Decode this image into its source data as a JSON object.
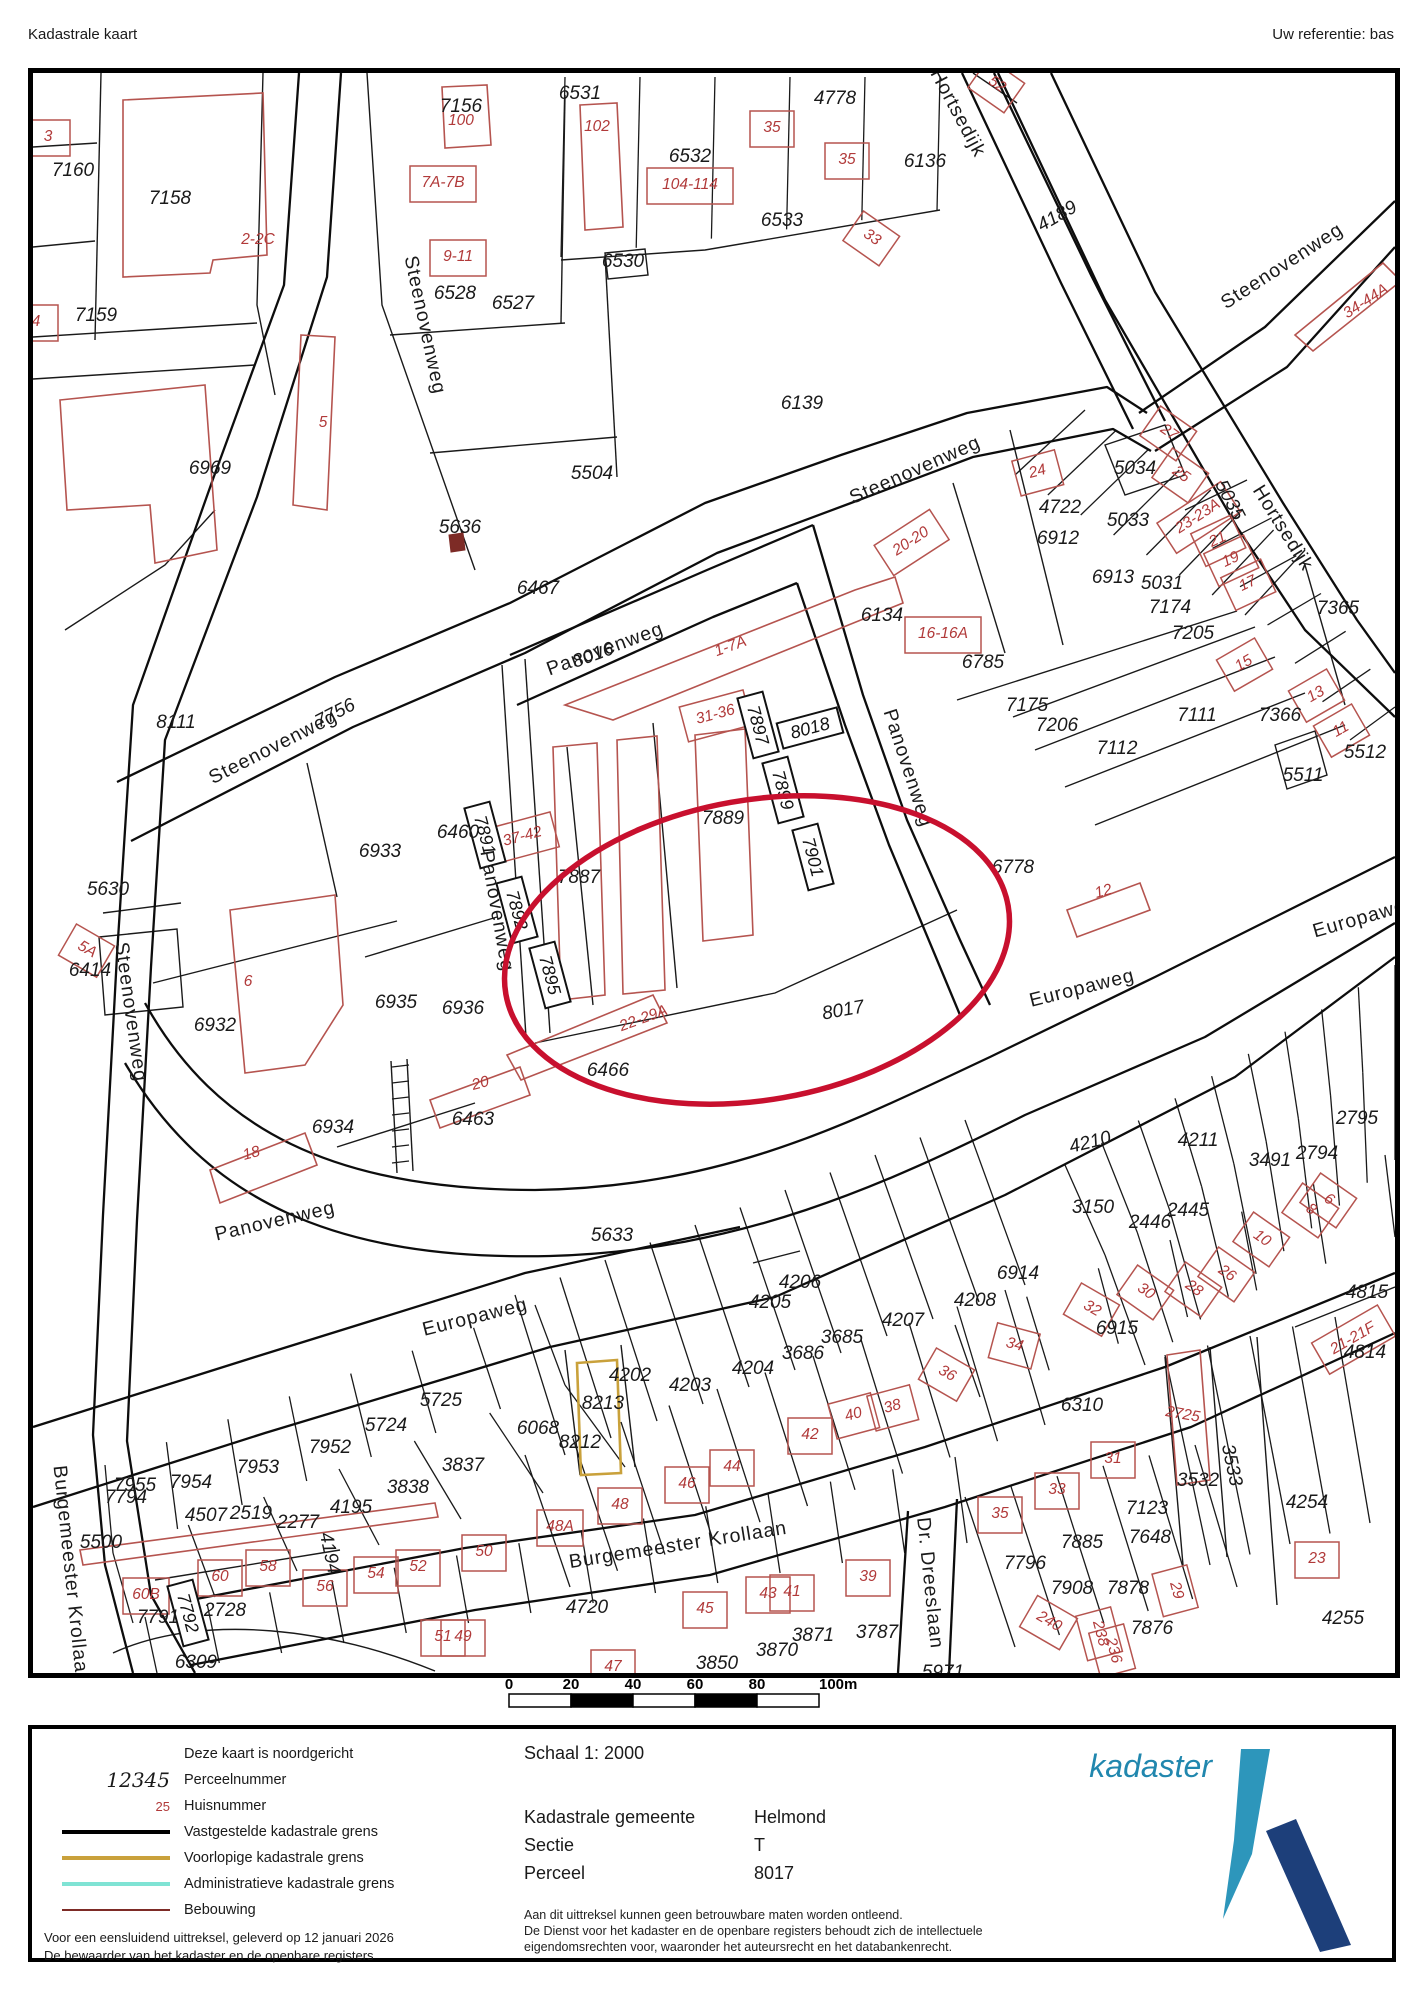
{
  "header": {
    "title": "Kadastrale kaart",
    "reference": "Uw referentie: bas"
  },
  "map": {
    "highlight_color": "#c8102e",
    "parcel_text_color": "#1a1a1a",
    "house_text_color": "#b13a3a",
    "building_color": "#b5544f",
    "boundary_color": "#1a1a1a",
    "provisional_color": "#c9a13b",
    "labels": [
      [
        "Steenovenweg",
        420,
        320,
        78,
        "r"
      ],
      [
        "Steenovenweg",
        268,
        742,
        -27,
        "r"
      ],
      [
        "Steenovenweg",
        910,
        465,
        -24,
        "r"
      ],
      [
        "Steenovenweg",
        1277,
        261,
        -33,
        "r"
      ],
      [
        "Steenovenweg",
        126,
        1007,
        82,
        "r"
      ],
      [
        "Hortsedijk",
        953,
        108,
        62,
        "r"
      ],
      [
        "Hortsedijk",
        1278,
        523,
        58,
        "r"
      ],
      [
        "Panovenweg",
        600,
        644,
        -20,
        "r"
      ],
      [
        "Panovenweg",
        903,
        763,
        72,
        "r"
      ],
      [
        "Panovenweg",
        492,
        906,
        80,
        "r"
      ],
      [
        "Panovenweg",
        270,
        1216,
        -13,
        "r"
      ],
      [
        "Europaweg",
        1077,
        983,
        -14,
        "r"
      ],
      [
        "Europaweg",
        1360,
        912,
        -16,
        "r"
      ],
      [
        "Europaweg",
        470,
        1312,
        -14,
        "r"
      ],
      [
        "Burgemeester Krollaan",
        673,
        1540,
        -9,
        "r"
      ],
      [
        "Burgemeester Krollaan",
        66,
        1570,
        84,
        "r"
      ],
      [
        "Dr. Dreeslaan",
        925,
        1578,
        84,
        "r"
      ],
      [
        "7160",
        68,
        165,
        0,
        "p"
      ],
      [
        "7158",
        165,
        193,
        0,
        "p"
      ],
      [
        "7159",
        91,
        310,
        0,
        "p"
      ],
      [
        "7156",
        456,
        101,
        0,
        "p"
      ],
      [
        "6528",
        450,
        288,
        0,
        "p"
      ],
      [
        "6527",
        508,
        298,
        0,
        "p"
      ],
      [
        "6531",
        575,
        88,
        0,
        "p"
      ],
      [
        "6530",
        618,
        256,
        0,
        "p"
      ],
      [
        "6532",
        685,
        151,
        0,
        "p"
      ],
      [
        "6533",
        777,
        215,
        0,
        "p"
      ],
      [
        "4778",
        830,
        93,
        0,
        "p"
      ],
      [
        "6136",
        920,
        156,
        0,
        "p"
      ],
      [
        "5504",
        587,
        468,
        0,
        "p"
      ],
      [
        "6139",
        797,
        398,
        0,
        "p"
      ],
      [
        "6969",
        205,
        463,
        0,
        "p"
      ],
      [
        "4189",
        1052,
        211,
        -30,
        "p"
      ],
      [
        "5034",
        1130,
        463,
        0,
        "p"
      ],
      [
        "5033",
        1123,
        515,
        0,
        "p"
      ],
      [
        "4722",
        1055,
        502,
        0,
        "p"
      ],
      [
        "6912",
        1053,
        533,
        0,
        "p"
      ],
      [
        "6913",
        1108,
        572,
        0,
        "p"
      ],
      [
        "5031",
        1157,
        578,
        0,
        "p"
      ],
      [
        "7174",
        1165,
        602,
        0,
        "p"
      ],
      [
        "5035",
        1225,
        495,
        62,
        "p"
      ],
      [
        "7205",
        1188,
        628,
        0,
        "p"
      ],
      [
        "7365",
        1333,
        603,
        0,
        "p"
      ],
      [
        "6785",
        978,
        657,
        0,
        "p"
      ],
      [
        "7175",
        1022,
        700,
        0,
        "p"
      ],
      [
        "7206",
        1052,
        720,
        0,
        "p"
      ],
      [
        "7112",
        1112,
        743,
        0,
        "p"
      ],
      [
        "7111",
        1192,
        710,
        0,
        "p"
      ],
      [
        "7366",
        1275,
        710,
        0,
        "p"
      ],
      [
        "5511",
        1298,
        770,
        0,
        "p"
      ],
      [
        "5512",
        1360,
        747,
        0,
        "p"
      ],
      [
        "6778",
        1008,
        862,
        0,
        "p"
      ],
      [
        "6134",
        877,
        610,
        0,
        "p"
      ],
      [
        "6467",
        533,
        583,
        0,
        "p"
      ],
      [
        "8016",
        588,
        650,
        -20,
        "p"
      ],
      [
        "7756",
        330,
        708,
        -27,
        "p"
      ],
      [
        "8111",
        171,
        717,
        0,
        "p"
      ],
      [
        "5636",
        455,
        522,
        0,
        "p"
      ],
      [
        "5630",
        103,
        884,
        0,
        "p"
      ],
      [
        "6414",
        85,
        965,
        0,
        "p"
      ],
      [
        "6933",
        375,
        846,
        0,
        "p"
      ],
      [
        "6460",
        453,
        827,
        0,
        "p"
      ],
      [
        "6932",
        210,
        1020,
        0,
        "p"
      ],
      [
        "6935",
        391,
        997,
        0,
        "p"
      ],
      [
        "6936",
        458,
        1003,
        0,
        "p"
      ],
      [
        "6934",
        328,
        1122,
        0,
        "p"
      ],
      [
        "7887",
        574,
        872,
        0,
        "p"
      ],
      [
        "7889",
        718,
        813,
        0,
        "p"
      ],
      [
        "8017",
        838,
        1005,
        -10,
        "p"
      ],
      [
        "6466",
        603,
        1065,
        0,
        "p"
      ],
      [
        "6463",
        468,
        1114,
        0,
        "p"
      ],
      [
        "5633",
        607,
        1230,
        0,
        "p"
      ],
      [
        "4206",
        795,
        1277,
        0,
        "p"
      ],
      [
        "4205",
        765,
        1297,
        0,
        "p"
      ],
      [
        "4207",
        898,
        1315,
        0,
        "p"
      ],
      [
        "3685",
        837,
        1332,
        0,
        "p"
      ],
      [
        "3686",
        798,
        1348,
        0,
        "p"
      ],
      [
        "4204",
        748,
        1363,
        0,
        "p"
      ],
      [
        "4203",
        685,
        1380,
        0,
        "p"
      ],
      [
        "4202",
        625,
        1370,
        0,
        "p"
      ],
      [
        "8213",
        598,
        1398,
        0,
        "p"
      ],
      [
        "8212",
        575,
        1437,
        0,
        "p"
      ],
      [
        "6068",
        533,
        1423,
        0,
        "p"
      ],
      [
        "4210",
        1085,
        1137,
        -14,
        "p"
      ],
      [
        "4211",
        1193,
        1135,
        0,
        "p"
      ],
      [
        "3491",
        1265,
        1155,
        0,
        "p"
      ],
      [
        "2794",
        1312,
        1148,
        0,
        "p"
      ],
      [
        "2795",
        1352,
        1113,
        0,
        "p"
      ],
      [
        "3150",
        1088,
        1202,
        0,
        "p"
      ],
      [
        "2446",
        1145,
        1217,
        0,
        "p"
      ],
      [
        "2445",
        1183,
        1205,
        0,
        "p"
      ],
      [
        "6914",
        1013,
        1268,
        0,
        "p"
      ],
      [
        "6915",
        1112,
        1323,
        0,
        "p"
      ],
      [
        "4208",
        970,
        1295,
        0,
        "p"
      ],
      [
        "6310",
        1077,
        1400,
        0,
        "p"
      ],
      [
        "4815",
        1362,
        1287,
        0,
        "p"
      ],
      [
        "4814",
        1360,
        1347,
        0,
        "p"
      ],
      [
        "3533",
        1227,
        1460,
        78,
        "p"
      ],
      [
        "3532",
        1193,
        1475,
        0,
        "p"
      ],
      [
        "7123",
        1142,
        1503,
        0,
        "p"
      ],
      [
        "7648",
        1145,
        1532,
        0,
        "p"
      ],
      [
        "7885",
        1077,
        1537,
        0,
        "p"
      ],
      [
        "7796",
        1020,
        1558,
        0,
        "p"
      ],
      [
        "4254",
        1302,
        1497,
        0,
        "p"
      ],
      [
        "4255",
        1338,
        1613,
        0,
        "p"
      ],
      [
        "7908",
        1067,
        1583,
        0,
        "p"
      ],
      [
        "7878",
        1123,
        1583,
        0,
        "p"
      ],
      [
        "7876",
        1147,
        1623,
        0,
        "p"
      ],
      [
        "5971",
        938,
        1667,
        0,
        "p"
      ],
      [
        "5725",
        436,
        1395,
        0,
        "p"
      ],
      [
        "5724",
        381,
        1420,
        0,
        "p"
      ],
      [
        "7952",
        325,
        1442,
        0,
        "p"
      ],
      [
        "3837",
        458,
        1460,
        0,
        "p"
      ],
      [
        "7953",
        253,
        1462,
        0,
        "p"
      ],
      [
        "3838",
        403,
        1482,
        0,
        "p"
      ],
      [
        "7954",
        186,
        1477,
        0,
        "p"
      ],
      [
        "7955",
        130,
        1480,
        0,
        "p"
      ],
      [
        "7794",
        121,
        1492,
        0,
        "p"
      ],
      [
        "4507",
        201,
        1510,
        0,
        "p"
      ],
      [
        "2519",
        246,
        1508,
        0,
        "p"
      ],
      [
        "2277",
        293,
        1517,
        0,
        "p"
      ],
      [
        "4195",
        346,
        1502,
        0,
        "p"
      ],
      [
        "4194",
        325,
        1548,
        78,
        "p"
      ],
      [
        "5500",
        96,
        1537,
        0,
        "p"
      ],
      [
        "7791",
        153,
        1612,
        0,
        "p"
      ],
      [
        "2728",
        220,
        1605,
        0,
        "p"
      ],
      [
        "6309",
        191,
        1657,
        0,
        "p"
      ],
      [
        "4720",
        582,
        1602,
        0,
        "p"
      ],
      [
        "3871",
        808,
        1630,
        0,
        "p"
      ],
      [
        "3870",
        772,
        1645,
        0,
        "p"
      ],
      [
        "3850",
        712,
        1658,
        0,
        "p"
      ],
      [
        "3787",
        872,
        1627,
        0,
        "p"
      ],
      [
        "3",
        43,
        130,
        0,
        "h"
      ],
      [
        "4",
        31,
        315,
        0,
        "h"
      ],
      [
        "100",
        456,
        114,
        0,
        "hn"
      ],
      [
        "2-2C",
        253,
        233,
        0,
        "hn"
      ],
      [
        "7A-7B",
        438,
        176,
        0,
        "h"
      ],
      [
        "9-11",
        453,
        250,
        0,
        "h"
      ],
      [
        "5",
        318,
        416,
        0,
        "hn"
      ],
      [
        "102",
        592,
        120,
        0,
        "hn"
      ],
      [
        "104-114",
        685,
        178,
        0,
        "h"
      ],
      [
        "35",
        767,
        121,
        0,
        "h"
      ],
      [
        "35",
        842,
        153,
        0,
        "h"
      ],
      [
        "33",
        868,
        231,
        35,
        "h"
      ],
      [
        "52",
        993,
        78,
        35,
        "h"
      ],
      [
        "24",
        1032,
        465,
        -15,
        "h"
      ],
      [
        "27",
        1165,
        426,
        35,
        "h"
      ],
      [
        "25",
        1177,
        468,
        35,
        "h"
      ],
      [
        "34-44A",
        1360,
        295,
        -33,
        "hn"
      ],
      [
        "20-20",
        905,
        535,
        -33,
        "h"
      ],
      [
        "23-23A",
        1192,
        510,
        -33,
        "h"
      ],
      [
        "21",
        1212,
        533,
        -25,
        "h"
      ],
      [
        "19",
        1225,
        553,
        -25,
        "h"
      ],
      [
        "17",
        1242,
        577,
        -25,
        "h"
      ],
      [
        "15",
        1238,
        657,
        -30,
        "h"
      ],
      [
        "13",
        1310,
        688,
        -30,
        "h"
      ],
      [
        "11",
        1335,
        723,
        -30,
        "h"
      ],
      [
        "16-16A",
        938,
        627,
        0,
        "h"
      ],
      [
        "12",
        1098,
        885,
        -15,
        "hn"
      ],
      [
        "1-7A",
        725,
        640,
        -20,
        "hn"
      ],
      [
        "31-36",
        710,
        708,
        -15,
        "h"
      ],
      [
        "37-42",
        517,
        830,
        -15,
        "h"
      ],
      [
        "22-29A",
        638,
        1012,
        -20,
        "hn"
      ],
      [
        "6",
        243,
        975,
        0,
        "hn"
      ],
      [
        "18",
        246,
        1147,
        -15,
        "hn"
      ],
      [
        "20",
        475,
        1077,
        -15,
        "hn"
      ],
      [
        "5A",
        83,
        943,
        30,
        "h"
      ],
      [
        "60B",
        141,
        1588,
        0,
        "h"
      ],
      [
        "60",
        215,
        1570,
        0,
        "h"
      ],
      [
        "58",
        263,
        1560,
        0,
        "h"
      ],
      [
        "56",
        320,
        1580,
        0,
        "h"
      ],
      [
        "54",
        371,
        1567,
        0,
        "h"
      ],
      [
        "52",
        413,
        1560,
        0,
        "h"
      ],
      [
        "50",
        479,
        1545,
        0,
        "h"
      ],
      [
        "48A",
        555,
        1520,
        0,
        "h"
      ],
      [
        "48",
        615,
        1498,
        0,
        "h"
      ],
      [
        "46",
        682,
        1477,
        0,
        "h"
      ],
      [
        "44",
        727,
        1460,
        0,
        "h"
      ],
      [
        "42",
        805,
        1428,
        0,
        "h"
      ],
      [
        "40",
        848,
        1408,
        -15,
        "h"
      ],
      [
        "38",
        887,
        1400,
        -15,
        "h"
      ],
      [
        "45",
        700,
        1602,
        0,
        "h"
      ],
      [
        "43",
        763,
        1587,
        0,
        "h"
      ],
      [
        "41",
        787,
        1585,
        0,
        "h"
      ],
      [
        "39",
        863,
        1570,
        0,
        "h"
      ],
      [
        "47",
        608,
        1660,
        0,
        "h"
      ],
      [
        "51",
        438,
        1630,
        0,
        "h"
      ],
      [
        "49",
        458,
        1630,
        0,
        "h"
      ],
      [
        "36",
        943,
        1367,
        30,
        "h"
      ],
      [
        "34",
        1010,
        1338,
        15,
        "h"
      ],
      [
        "32",
        1088,
        1302,
        30,
        "h"
      ],
      [
        "31",
        1108,
        1452,
        0,
        "h"
      ],
      [
        "33",
        1052,
        1483,
        0,
        "h"
      ],
      [
        "35",
        995,
        1507,
        0,
        "h"
      ],
      [
        "29",
        1173,
        1585,
        75,
        "h"
      ],
      [
        "240",
        1045,
        1615,
        30,
        "h"
      ],
      [
        "238",
        1097,
        1628,
        75,
        "h"
      ],
      [
        "236",
        1110,
        1645,
        75,
        "h"
      ],
      [
        "23",
        1312,
        1552,
        0,
        "h"
      ],
      [
        "21-21F",
        1347,
        1332,
        -30,
        "h"
      ],
      [
        "2725",
        1178,
        1408,
        10,
        "hn"
      ],
      [
        "26",
        1223,
        1267,
        35,
        "h"
      ],
      [
        "28",
        1190,
        1282,
        35,
        "h"
      ],
      [
        "30",
        1142,
        1285,
        35,
        "h"
      ],
      [
        "10",
        1258,
        1232,
        35,
        "h"
      ],
      [
        "8",
        1307,
        1203,
        35,
        "h"
      ],
      [
        "6",
        1325,
        1193,
        35,
        "h"
      ]
    ],
    "boxed_labels": [
      [
        "7891",
        480,
        830,
        75
      ],
      [
        "7892",
        512,
        905,
        75
      ],
      [
        "7895",
        545,
        970,
        75
      ],
      [
        "7897",
        753,
        720,
        75
      ],
      [
        "7899",
        778,
        785,
        75
      ],
      [
        "7901",
        808,
        852,
        75
      ],
      [
        "8018",
        805,
        723,
        -15
      ],
      [
        "7792",
        183,
        1608,
        75
      ]
    ],
    "highlight_parcel": "8017"
  },
  "scalebar": {
    "ticks": [
      "0",
      "20",
      "40",
      "60",
      "80",
      "100m"
    ]
  },
  "legend": {
    "items": [
      {
        "kind": "none",
        "sample": "",
        "label": "Deze kaart is noordgericht"
      },
      {
        "kind": "pnum",
        "sample": "12345",
        "label": "Perceelnummer"
      },
      {
        "kind": "hnum",
        "sample": "25",
        "label": "Huisnummer"
      },
      {
        "kind": "line",
        "color": "#000000",
        "label": "Vastgestelde kadastrale grens"
      },
      {
        "kind": "line",
        "color": "#c9a13b",
        "label": "Voorlopige kadastrale grens"
      },
      {
        "kind": "line",
        "color": "#7fe3d4",
        "label": "Administratieve kadastrale grens"
      },
      {
        "kind": "line",
        "color": "#7d2b26",
        "label": "Bebouwing"
      }
    ],
    "credits": [
      "Voor een eensluidend uittreksel, geleverd op 12 januari 2026",
      "De bewaarder van het kadaster en de openbare registers"
    ]
  },
  "info": {
    "scale": "Schaal 1: 2000",
    "rows": [
      [
        "Kadastrale gemeente",
        "Helmond"
      ],
      [
        "Sectie",
        "T"
      ],
      [
        "Perceel",
        "8017"
      ]
    ],
    "disclaimer": [
      "Aan dit uittreksel kunnen geen betrouwbare maten worden ontleend.",
      "De Dienst voor het kadaster en de openbare registers behoudt zich de intellectuele",
      "eigendomsrechten voor, waaronder het auteursrecht en het databankenrecht."
    ]
  },
  "logo": {
    "text": "kadaster",
    "text_color": "#2187ae",
    "light_color": "#2d96bb",
    "dark_color": "#1d3f7a"
  }
}
